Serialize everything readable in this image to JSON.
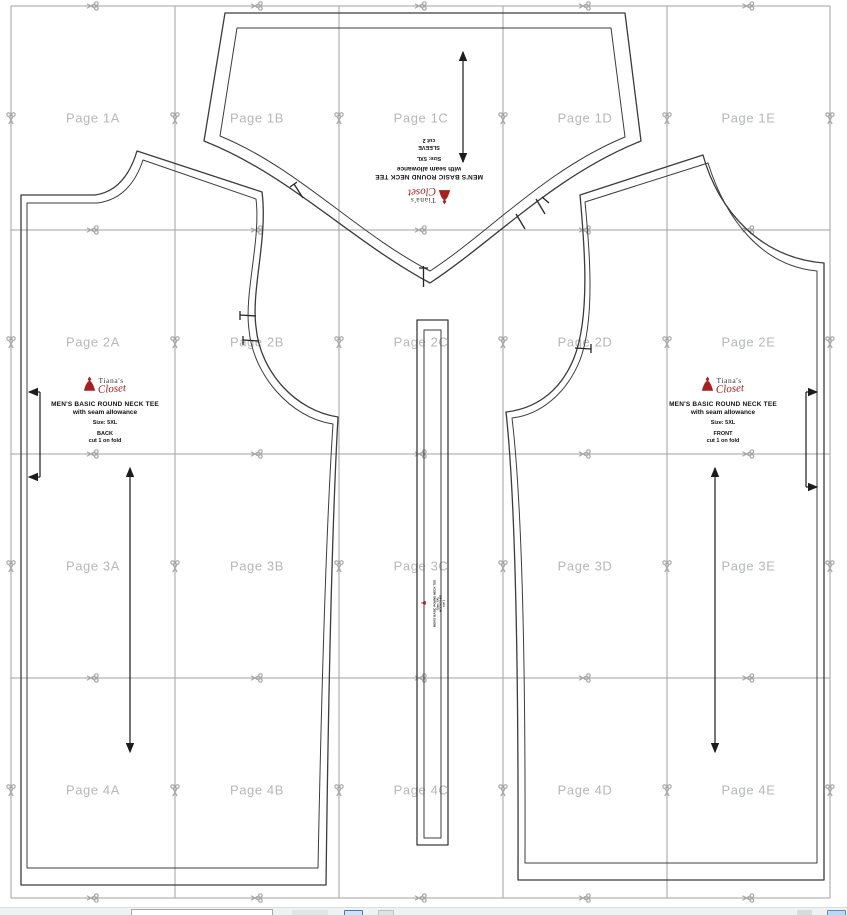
{
  "page": {
    "background": "#ffffff"
  },
  "grid": {
    "page_labels": [
      [
        "Page 1A",
        "Page 1B",
        "Page 1C",
        "Page 1D",
        "Page 1E"
      ],
      [
        "Page 2A",
        "Page 2B",
        "Page 2C",
        "Page 2D",
        "Page 2E"
      ],
      [
        "Page 3A",
        "Page 3B",
        "Page 3C",
        "Page 3D",
        "Page 3E"
      ],
      [
        "Page 4A",
        "Page 4B",
        "Page 4C",
        "Page 4D",
        "Page 4E"
      ]
    ],
    "label_color": "#b5b7b9",
    "line_color": "#a2a2a2",
    "scissors_color": "#a6a6a6"
  },
  "brand": {
    "top": "Tiana's",
    "bottom": "Closet",
    "accent": "#a6201f"
  },
  "outline_color": "#3c3c3c",
  "pieces": {
    "back": {
      "title": "MEN'S BASIC ROUND NECK TEE",
      "subtitle": "with seam allowance",
      "size": "Size: 5XL",
      "name": "BACK",
      "cut": "cut 1 on fold"
    },
    "front": {
      "title": "MEN'S BASIC ROUND NECK TEE",
      "subtitle": "with seam allowance",
      "size": "Size: 5XL",
      "name": "FRONT",
      "cut": "cut 1 on fold"
    },
    "sleeve": {
      "title": "MEN'S BASIC ROUND NECK TEE",
      "subtitle": "with seam allowance",
      "size": "Size: 5XL",
      "name": "SLEEVE",
      "cut": "cut 2"
    },
    "neckband": {
      "title": "MEN'S BASIC ROUND NECK TEE",
      "size": "Size: 5XL",
      "name": "NECKBAND",
      "cut": "cut 1"
    }
  }
}
